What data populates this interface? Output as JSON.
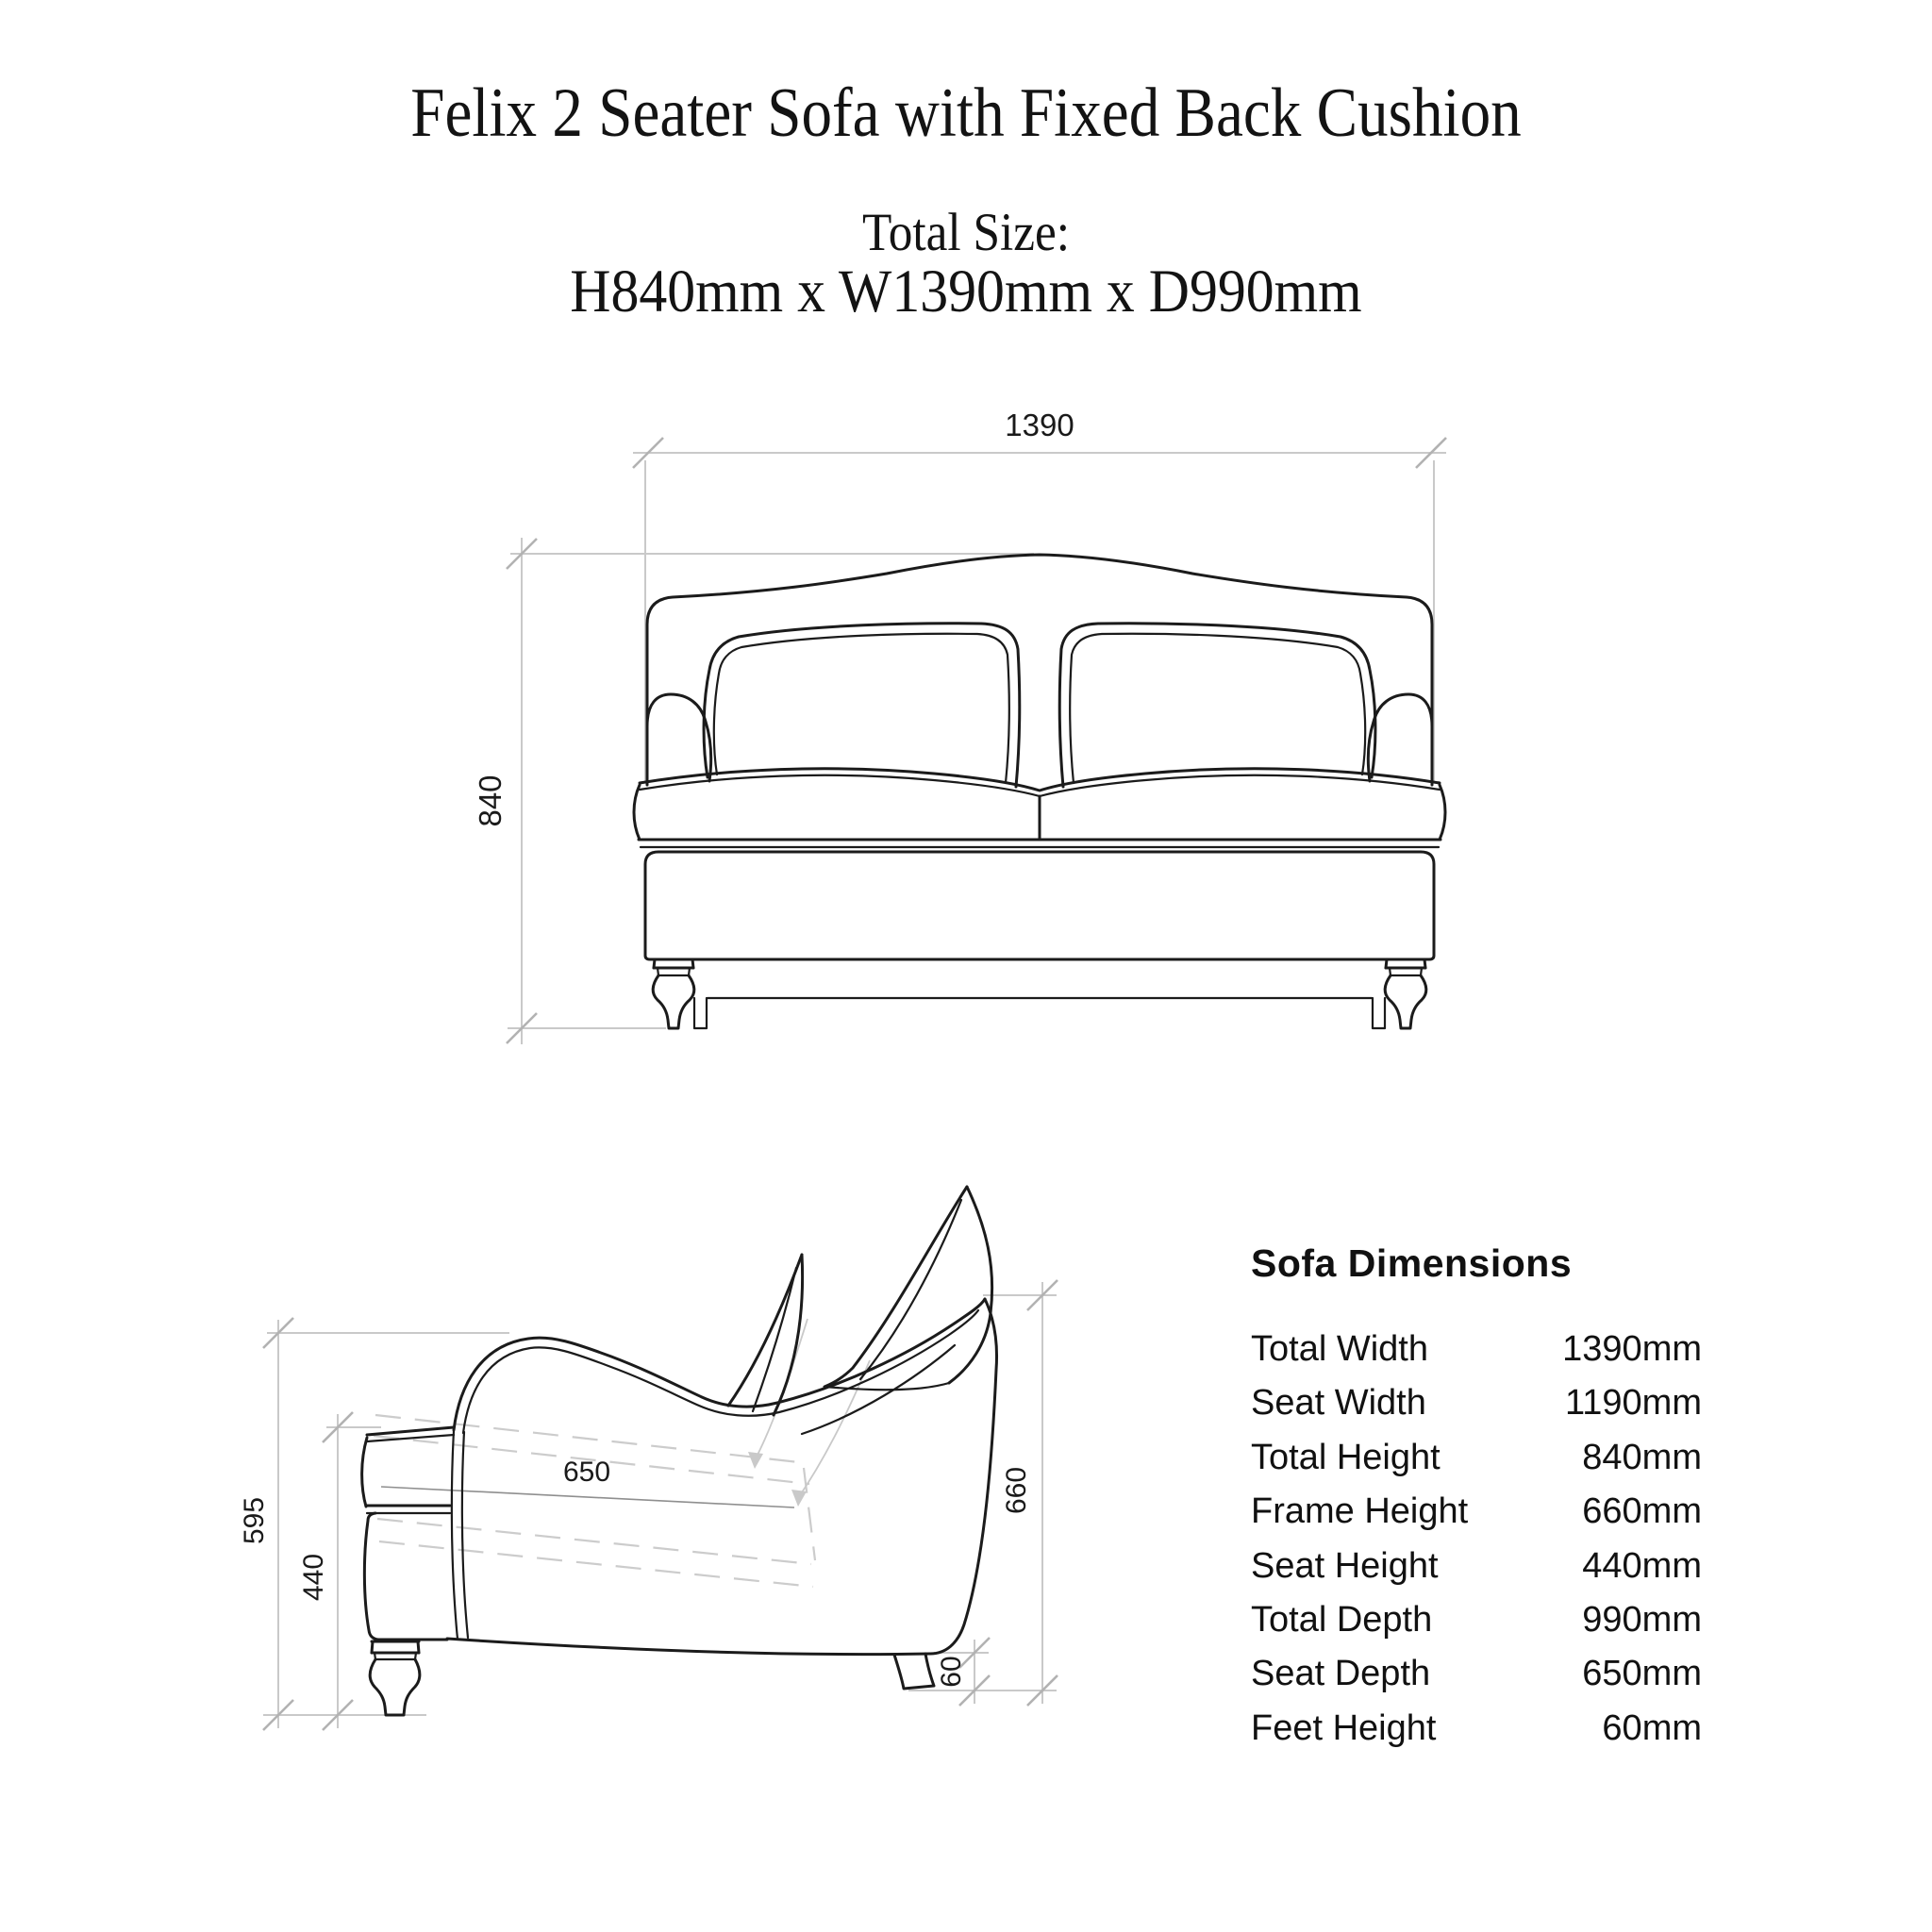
{
  "page": {
    "title": "Felix 2 Seater Sofa with Fixed Back Cushion",
    "size_heading": "Total Size:",
    "size_value": "H840mm x W1390mm x D990mm"
  },
  "front_view": {
    "width_label": "1390",
    "height_label": "840"
  },
  "side_view": {
    "arm_height_label": "595",
    "seat_height_label": "440",
    "seat_depth_label": "650",
    "frame_height_label": "660",
    "feet_height_label": "60"
  },
  "dimensions_table": {
    "heading": "Sofa Dimensions",
    "rows": [
      {
        "label": "Total Width",
        "value": "1390mm"
      },
      {
        "label": "Seat Width",
        "value": "1190mm"
      },
      {
        "label": "Total Height",
        "value": "840mm"
      },
      {
        "label": "Frame Height",
        "value": "660mm"
      },
      {
        "label": "Seat Height",
        "value": "440mm"
      },
      {
        "label": "Total Depth",
        "value": "990mm"
      },
      {
        "label": "Seat Depth",
        "value": "650mm"
      },
      {
        "label": "Feet Height",
        "value": "60mm"
      }
    ]
  }
}
